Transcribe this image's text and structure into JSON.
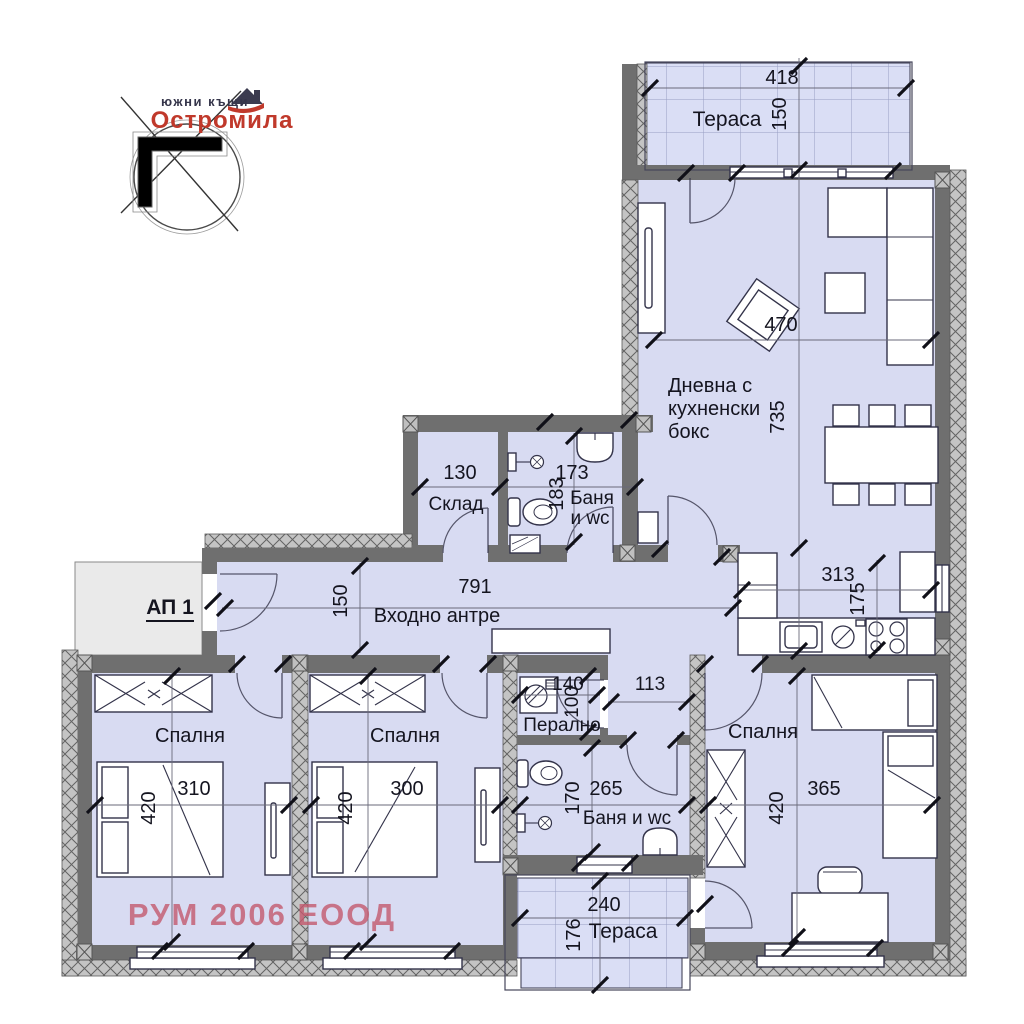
{
  "logo": {
    "tagline": "южни къщи",
    "brand": "Остромила"
  },
  "watermark": "РУМ 2006 ЕООД",
  "entrance": {
    "label": "АП 1"
  },
  "rooms": {
    "terrace_top": {
      "name": "Тераса",
      "dim_w": "418",
      "dim_h": "150"
    },
    "living": {
      "line1": "Дневна с",
      "line2": "кухненски",
      "line3": "бокс",
      "dim_w": "470",
      "dim_h": "735"
    },
    "kitchen": {
      "dim_w": "313",
      "dim_h": "175"
    },
    "storage": {
      "name": "Склад",
      "dim_w": "130"
    },
    "bath1": {
      "name1": "Баня",
      "name2": "и wc",
      "dim_w": "173",
      "dim_h": "183"
    },
    "hall": {
      "name": "Входно антре",
      "dim_w": "791",
      "dim_h": "150"
    },
    "bedroom1": {
      "name": "Спалня",
      "dim_w": "310",
      "dim_h": "420"
    },
    "bedroom2": {
      "name": "Спалня",
      "dim_w": "300",
      "dim_h": "420"
    },
    "bedroom3": {
      "name": "Спалня",
      "dim_w": "365",
      "dim_h": "420"
    },
    "laundry": {
      "name": "Перално",
      "dim_w": "140",
      "dim_h": "100"
    },
    "corridor": {
      "dim_w": "113"
    },
    "bath2": {
      "name": "Баня и wc",
      "dim_w": "265",
      "dim_h": "170"
    },
    "terrace_bottom": {
      "name": "Тераса",
      "dim_w": "240",
      "dim_h": "176"
    }
  },
  "colors": {
    "room_fill": "#d8dbf2",
    "terrace_fill": "#dadef5",
    "wall": "#6f6f6f",
    "brand_red": "#c0392b",
    "watermark": "#c45a6e"
  }
}
